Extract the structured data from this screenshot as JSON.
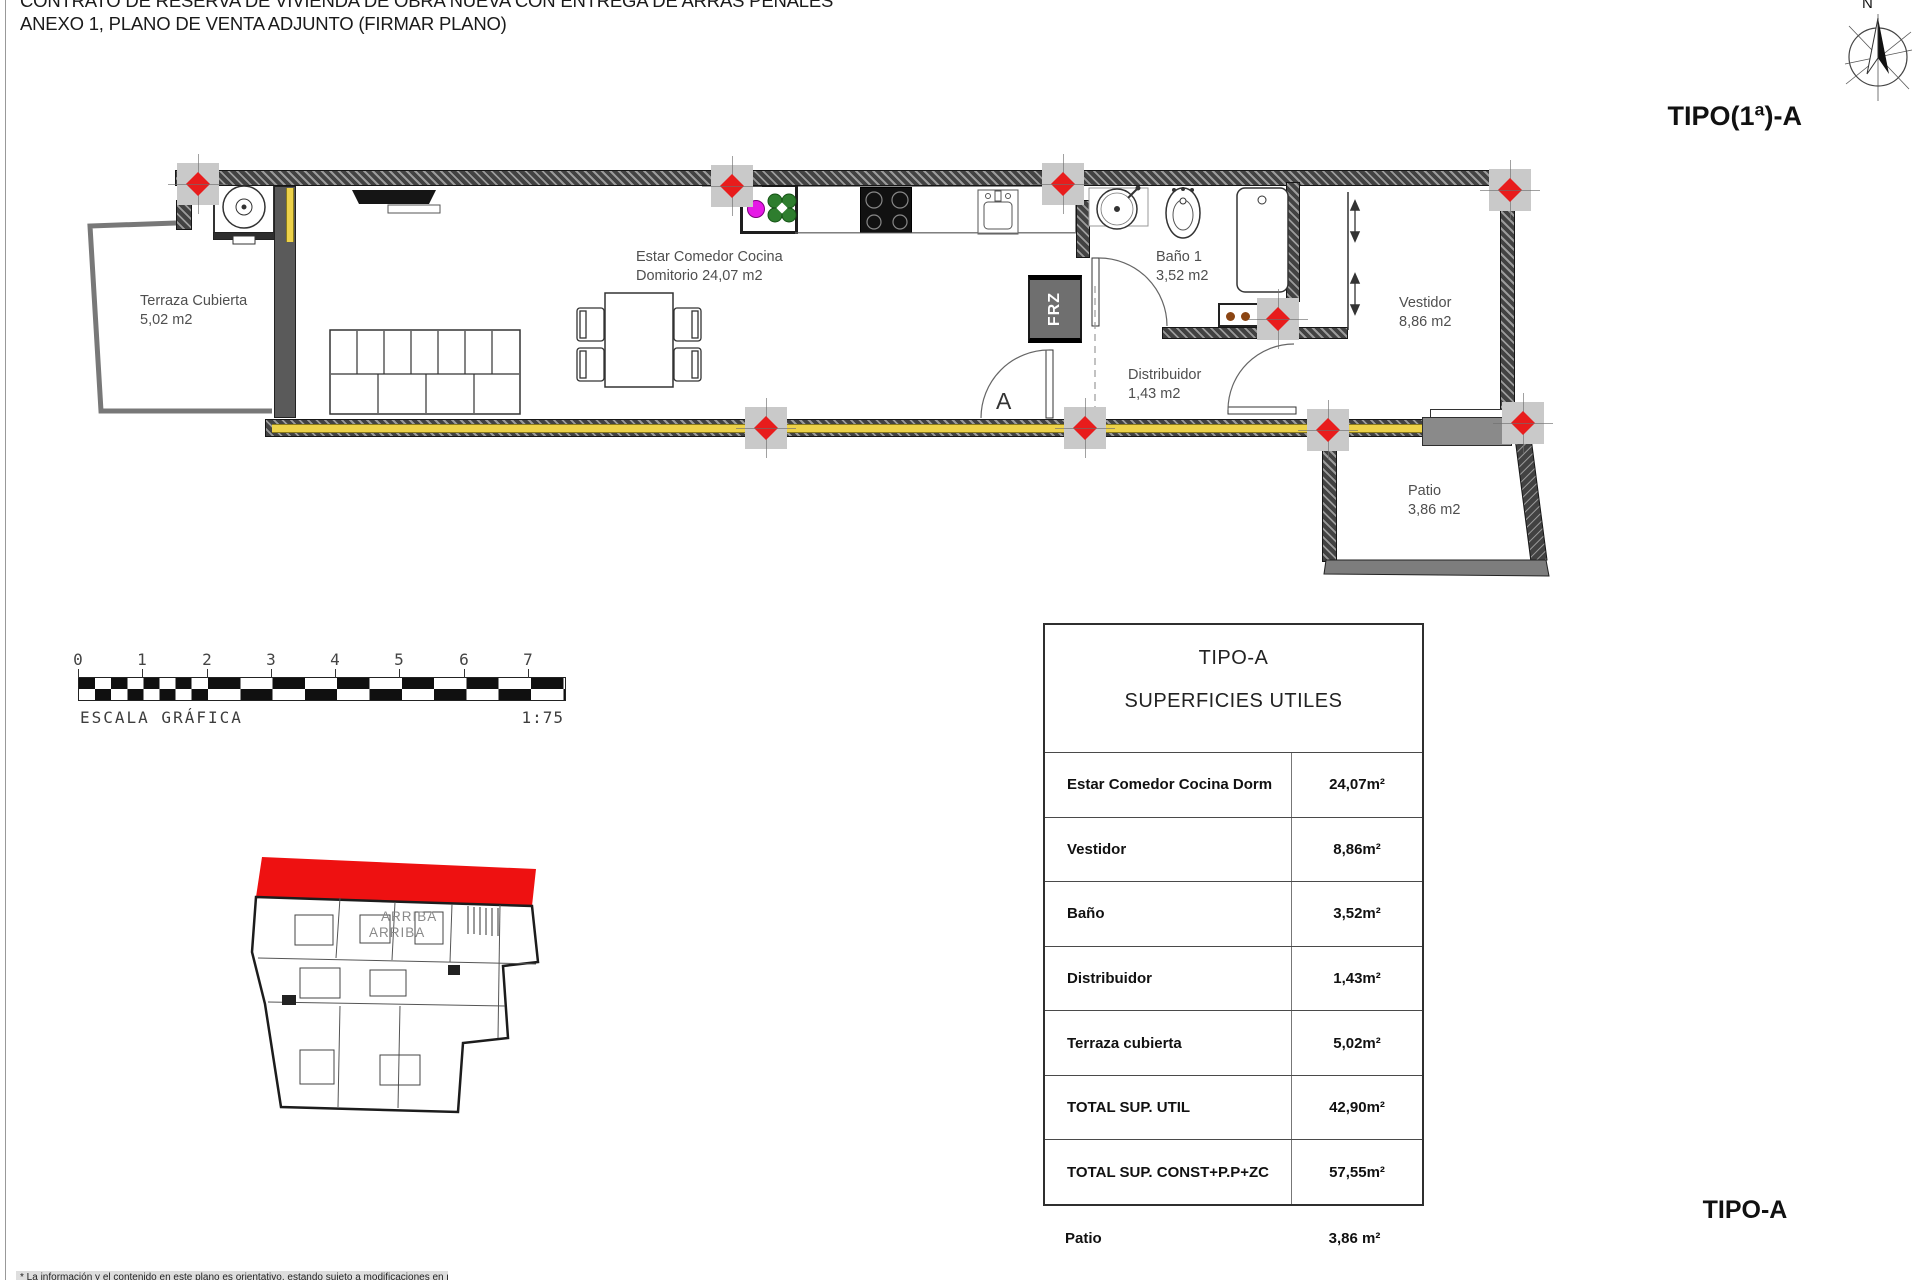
{
  "header": {
    "title_line1": "CONTRATO DE RESERVA DE VIVIENDA DE OBRA NUEVA CON ENTREGA DE ARRAS PENALES",
    "title_line2": "ANEXO 1, PLANO DE VENTA ADJUNTO (FIRMAR PLANO)",
    "type_label": "TIPO(1ª)-A",
    "compass_north": "N"
  },
  "plan": {
    "labels": {
      "terraza": {
        "line1": "Terraza Cubierta",
        "line2": "5,02 m2"
      },
      "estar": {
        "line1": "Estar Comedor Cocina",
        "line2": "Domitorio 24,07 m2"
      },
      "bano": {
        "line1": "Baño 1",
        "line2": "3,52 m2"
      },
      "distribuidor": {
        "line1": "Distribuidor",
        "line2": "1,43 m2"
      },
      "vestidor": {
        "line1": "Vestidor",
        "line2": "8,86 m2"
      },
      "patio": {
        "line1": "Patio",
        "line2": "3,86 m2"
      }
    },
    "frz_label": "FRZ",
    "section_label": "A"
  },
  "scale_bar": {
    "numbers": [
      "0",
      "1",
      "2",
      "3",
      "4",
      "5",
      "6",
      "7"
    ],
    "label": "ESCALA GRÁFICA",
    "ratio": "1:75"
  },
  "key_plan": {
    "arriba1": "ARRIBA",
    "arriba2": "ARRIBA",
    "highlight_color": "#ee1111"
  },
  "areas_table": {
    "title_line1": "TIPO-A",
    "title_line2": "SUPERFICIES UTILES",
    "rows": [
      {
        "label": "Estar Comedor Cocina Dorm",
        "value": "24,07m²"
      },
      {
        "label": "Vestidor",
        "value": "8,86m²"
      },
      {
        "label": "Baño",
        "value": "3,52m²"
      },
      {
        "label": "Distribuidor",
        "value": "1,43m²"
      },
      {
        "label": "Terraza cubierta",
        "value": "5,02m²"
      },
      {
        "label": "TOTAL SUP. UTIL",
        "value": "42,90m²"
      },
      {
        "label": "TOTAL SUP. CONST+P.P+ZC",
        "value": "57,55m²"
      }
    ],
    "footer_row": {
      "label": "Patio",
      "value": "3,86 m²"
    }
  },
  "footer": {
    "type_label": "TIPO-A",
    "disclaimer": "* La información y el contenido en este plano es orientativo, estando sujeto a modificaciones en proyecto"
  },
  "colors": {
    "marker_red": "#e81c1c",
    "insulation_yellow": "#edd24a",
    "highlight_red": "#ee1111"
  }
}
